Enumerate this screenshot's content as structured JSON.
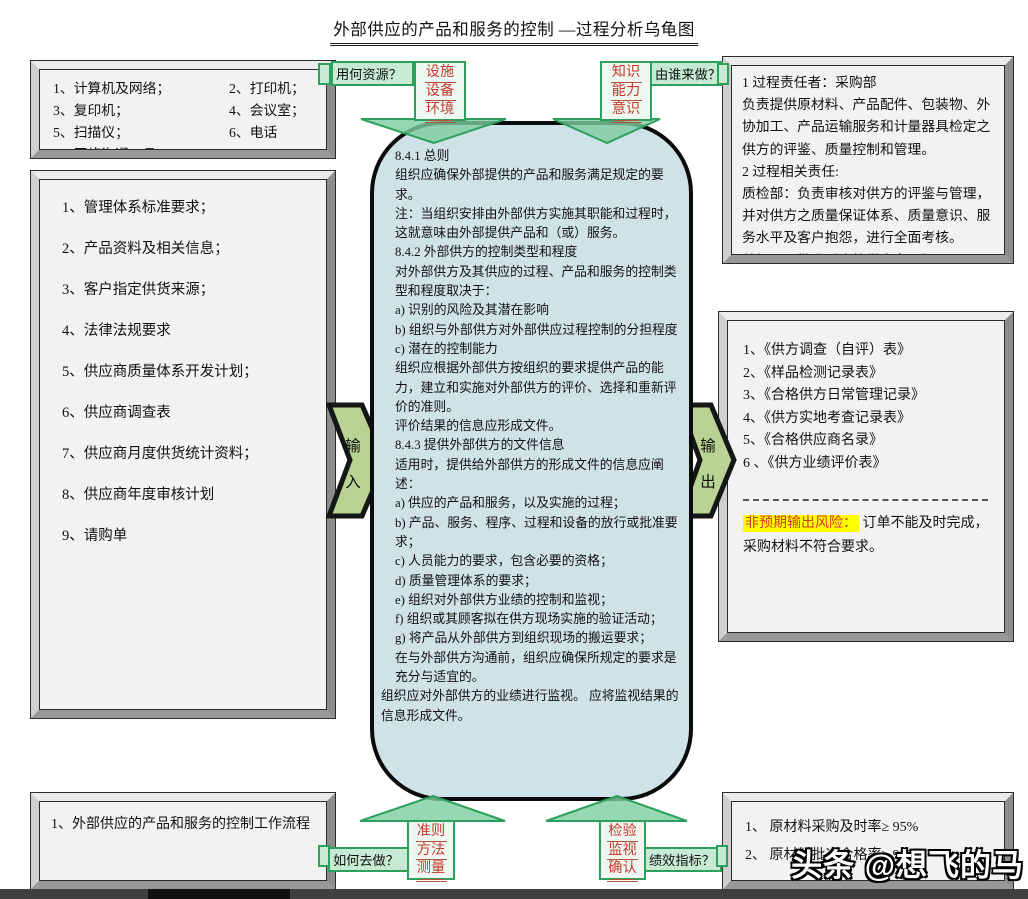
{
  "title": "外部供应的产品和服务的控制 —过程分析乌龟图",
  "resources_box": {
    "items": [
      "1、计算机及网络；",
      "2、打印机；",
      "3、复印机；",
      "4、会议室；",
      "5、扫描仪；",
      "6、电话",
      "7、网络沟通工具"
    ]
  },
  "responsibility_box": {
    "lines": [
      "1 过程责任者：采购部",
      "负责提供原材料、产品配件、包装物、外协加工、产品运输服务和计量器具检定之供方的评鉴、质量控制和管理。",
      "2 过程相关责任:",
      "质检部：负责审核对供方的评鉴与管理，并对供方之质量保证体系、质量意识、服务水平及客户抱怨，进行全面考核。",
      "总经理：批准《合格供方名录》。"
    ]
  },
  "inputs_box": {
    "items": [
      "1、管理体系标准要求；",
      "2、产品资料及相关信息；",
      "3、客户指定供货来源；",
      "4、法律法规要求",
      "5、供应商质量体系开发计划；",
      "6、供应商调查表",
      "7、供应商月度供货统计资料；",
      "8、供应商年度审核计划",
      "9、请购单"
    ]
  },
  "turtle_body": {
    "paragraphs": [
      {
        "t": "8.4.1 总则",
        "cls": ""
      },
      {
        "t": "组织应确保外部提供的产品和服务满足规定的要求。",
        "cls": ""
      },
      {
        "t": "注：当组织安排由外部供方实施其职能和过程时，这就意味由外部提供产品和（或）服务。",
        "cls": ""
      },
      {
        "t": "8.4.2 外部供方的控制类型和程度",
        "cls": ""
      },
      {
        "t": "对外部供方及其供应的过程、产品和服务的控制类型和程度取决于：",
        "cls": ""
      },
      {
        "t": "a) 识别的风险及其潜在影响",
        "cls": ""
      },
      {
        "t": "b) 组织与外部供方对外部供应过程控制的分担程度",
        "cls": ""
      },
      {
        "t": "c) 潜在的控制能力",
        "cls": ""
      },
      {
        "t": "组织应根据外部供方按组织的要求提供产品的能力，建立和实施对外部供方的评价、选择和重新评价的准则。",
        "cls": ""
      },
      {
        "t": "评价结果的信息应形成文件。",
        "cls": ""
      },
      {
        "t": "8.4.3 提供外部供方的文件信息",
        "cls": ""
      },
      {
        "t": "适用时，提供给外部供方的形成文件的信息应阐述：",
        "cls": ""
      },
      {
        "t": "a) 供应的产品和服务，以及实施的过程；",
        "cls": ""
      },
      {
        "t": "b) 产品、服务、程序、过程和设备的放行或批准要求；",
        "cls": ""
      },
      {
        "t": "c) 人员能力的要求，包含必要的资格；",
        "cls": ""
      },
      {
        "t": "d) 质量管理体系的要求；",
        "cls": ""
      },
      {
        "t": "e) 组织对外部供方业绩的控制和监视；",
        "cls": ""
      },
      {
        "t": "f) 组织或其顾客拟在供方现场实施的验证活动；",
        "cls": ""
      },
      {
        "t": "g) 将产品从外部供方到组织现场的搬运要求；",
        "cls": ""
      },
      {
        "t": "在与外部供方沟通前，组织应确保所规定的要求是充分与适宜的。",
        "cls": ""
      },
      {
        "t": "组织应对外部供方的业绩进行监视。 应将监视结果的信息形成文件。",
        "cls": "out"
      }
    ]
  },
  "outputs_box": {
    "items": [
      "1、《供方调查（自评）表》",
      "2、《样品检测记录表》",
      "3、《合格供方日常管理记录》",
      "4、《供方实地考查记录表》",
      "5、《合格供应商名录》",
      "6 、《供方业绩评价表》"
    ],
    "risk_label": "非预期输出风险：",
    "risk_text_1": " 订单不能及时完成，",
    "risk_text_2": "采购材料不符合要求。"
  },
  "flow_box": {
    "items": [
      "1、外部供应的产品和服务的控制工作流程"
    ]
  },
  "kpi_box": {
    "items": [
      "1、 原材料采购及时率≥ 95%",
      "2、 原材料批次合格率≥ 99%"
    ]
  },
  "questions": {
    "resources": "用何资源？",
    "who": "由谁来做？",
    "how": "如何去做？",
    "kpi": "绩效指标？"
  },
  "stems": {
    "top_left": [
      "设施",
      "设备",
      "环境"
    ],
    "top_right": [
      "知识",
      "能力",
      "意识"
    ],
    "bottom_left": [
      "准则",
      "方法",
      "测量"
    ],
    "bottom_right": [
      "检验",
      "监视",
      "确认"
    ]
  },
  "flows": {
    "input_1": "输",
    "input_2": "入",
    "output_1": "输",
    "output_2": "出"
  },
  "watermark": "头条 @想飞的马",
  "colors": {
    "green_border": "#2ca05c",
    "green_fill": "#c6ead3",
    "arrow_head_fill": "#7ecda0",
    "turtle_fill": "#cfe2e8",
    "side_arrow_fill": "#b9d395",
    "red_text": "#c23b2e",
    "risk_highlight": "#ffff00"
  }
}
